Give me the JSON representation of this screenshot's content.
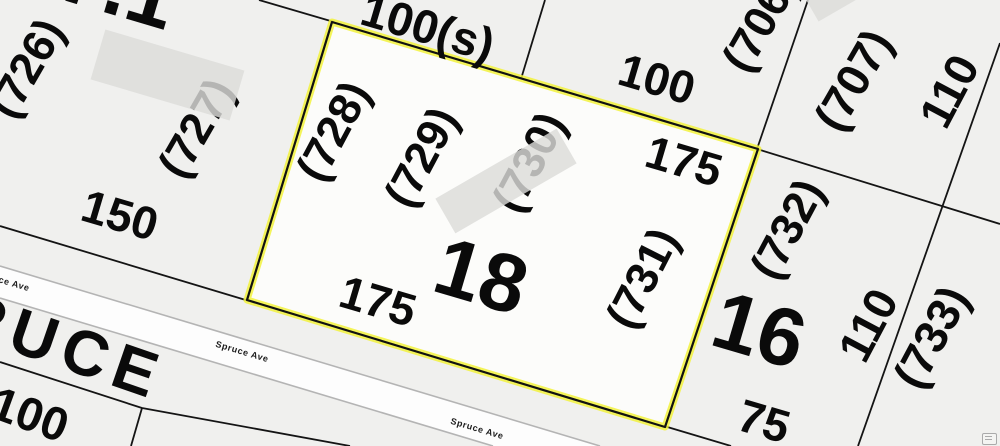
{
  "map_type": "cadastral-parcel-map",
  "street": {
    "name_large": "RUCE",
    "label": "Spruce Ave"
  },
  "selection": {
    "lot_number": "18",
    "outline_color": "#f2f23c",
    "frontage_label": "175",
    "rear_label": "100(s)",
    "address_labels": [
      "(728)",
      "(729)",
      "(730)",
      "(731)"
    ]
  },
  "labels": {
    "lot71": "7.1",
    "p726": "(726)",
    "p727": "(727)",
    "d150": "150",
    "d100s": "100(s)",
    "d100n": "100",
    "d175e": "175",
    "p706": "(706)",
    "p707": "(707)",
    "d110n": "110",
    "p728": "(728)",
    "p729": "(729)",
    "p730": "(730)",
    "lot18": "18",
    "d175s": "175",
    "p731": "(731)",
    "p732": "(732)",
    "lot16": "16",
    "d110m": "110",
    "p733": "(733)",
    "d75": "75",
    "d100sw": "100"
  },
  "colors": {
    "background": "#f0f0ee",
    "selected_parcel_fill": "#fcfcfa",
    "road_fill": "#fdfdfd",
    "parcel_line": "#141414",
    "road_edge": "#b4b4b4",
    "building_fill": "#dcdcd9",
    "selection_outline": "#f2f23c"
  },
  "watermark_icon": "list-icon"
}
